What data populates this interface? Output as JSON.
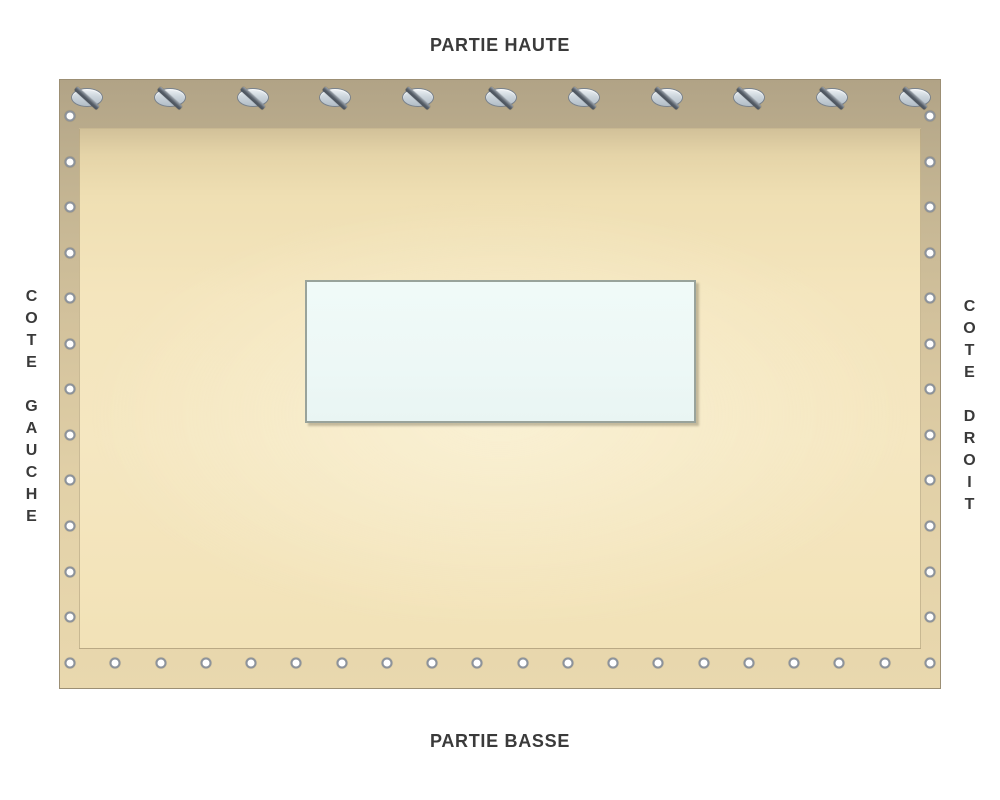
{
  "labels": {
    "top": "PARTIE HAUTE",
    "bottom": "PARTIE BASSE",
    "left": "COTE GAUCHE",
    "right": "COTE DROIT"
  },
  "fasteners": {
    "screw_count_top": 11,
    "eyelet_count_left": 12,
    "eyelet_count_right": 12,
    "eyelet_count_bottom": 20
  },
  "colors": {
    "text": "#3a3a3a",
    "tarp_top": "#b1a386",
    "tarp_bottom": "#e9d8ae",
    "inner_field": "#f4e5bd",
    "window_fill": "#edf8f6",
    "window_border": "#99a39b",
    "screw_fill": "#ccd5dc",
    "eyelet_ring": "#8d939b"
  }
}
